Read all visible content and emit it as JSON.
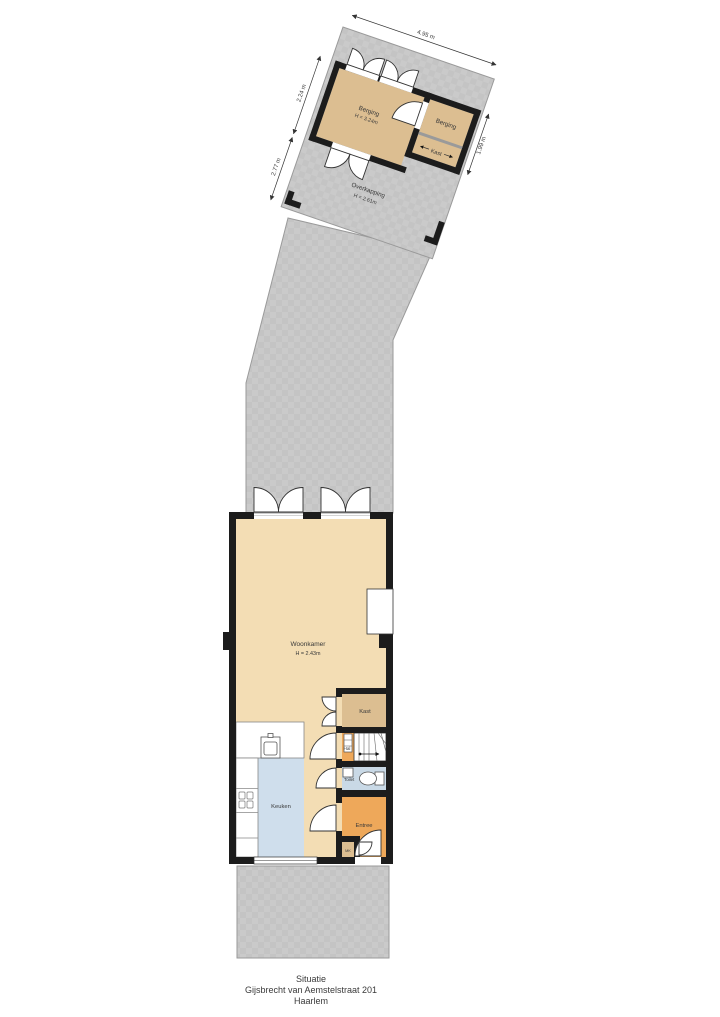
{
  "caption": {
    "line1": "Situatie",
    "line2": "Gijsbrecht van Aemstelstraat 201",
    "line3": "Haarlem"
  },
  "outbuilding": {
    "berging1": {
      "label": "Berging",
      "height": "H = 3.24m"
    },
    "berging2": {
      "label": "Berging"
    },
    "kast": {
      "label": "Kast"
    },
    "overkapping": {
      "label": "Overkapping",
      "height": "H = 2.61m"
    },
    "dimensions": {
      "top": "4.95 m",
      "left_upper": "2.24 m",
      "left_lower": "2.77 m",
      "right": "1.99 m"
    }
  },
  "house": {
    "woonkamer": {
      "label": "Woonkamer",
      "height": "H = 2.43m"
    },
    "keuken": {
      "label": "Keuken"
    },
    "kast": {
      "label": "Kast"
    },
    "hal": {
      "label": "Hal"
    },
    "toilet": {
      "label": "Toilet"
    },
    "entree": {
      "label": "Entree"
    },
    "mk": {
      "label": "MK"
    }
  },
  "colors": {
    "floor_beige": "#f3ddb4",
    "floor_tan": "#dcbe91",
    "floor_orange": "#eea85a",
    "floor_blue": "#cfdeec",
    "wall_black": "#1c1c1c",
    "terrain_gray": "#cacaca"
  }
}
